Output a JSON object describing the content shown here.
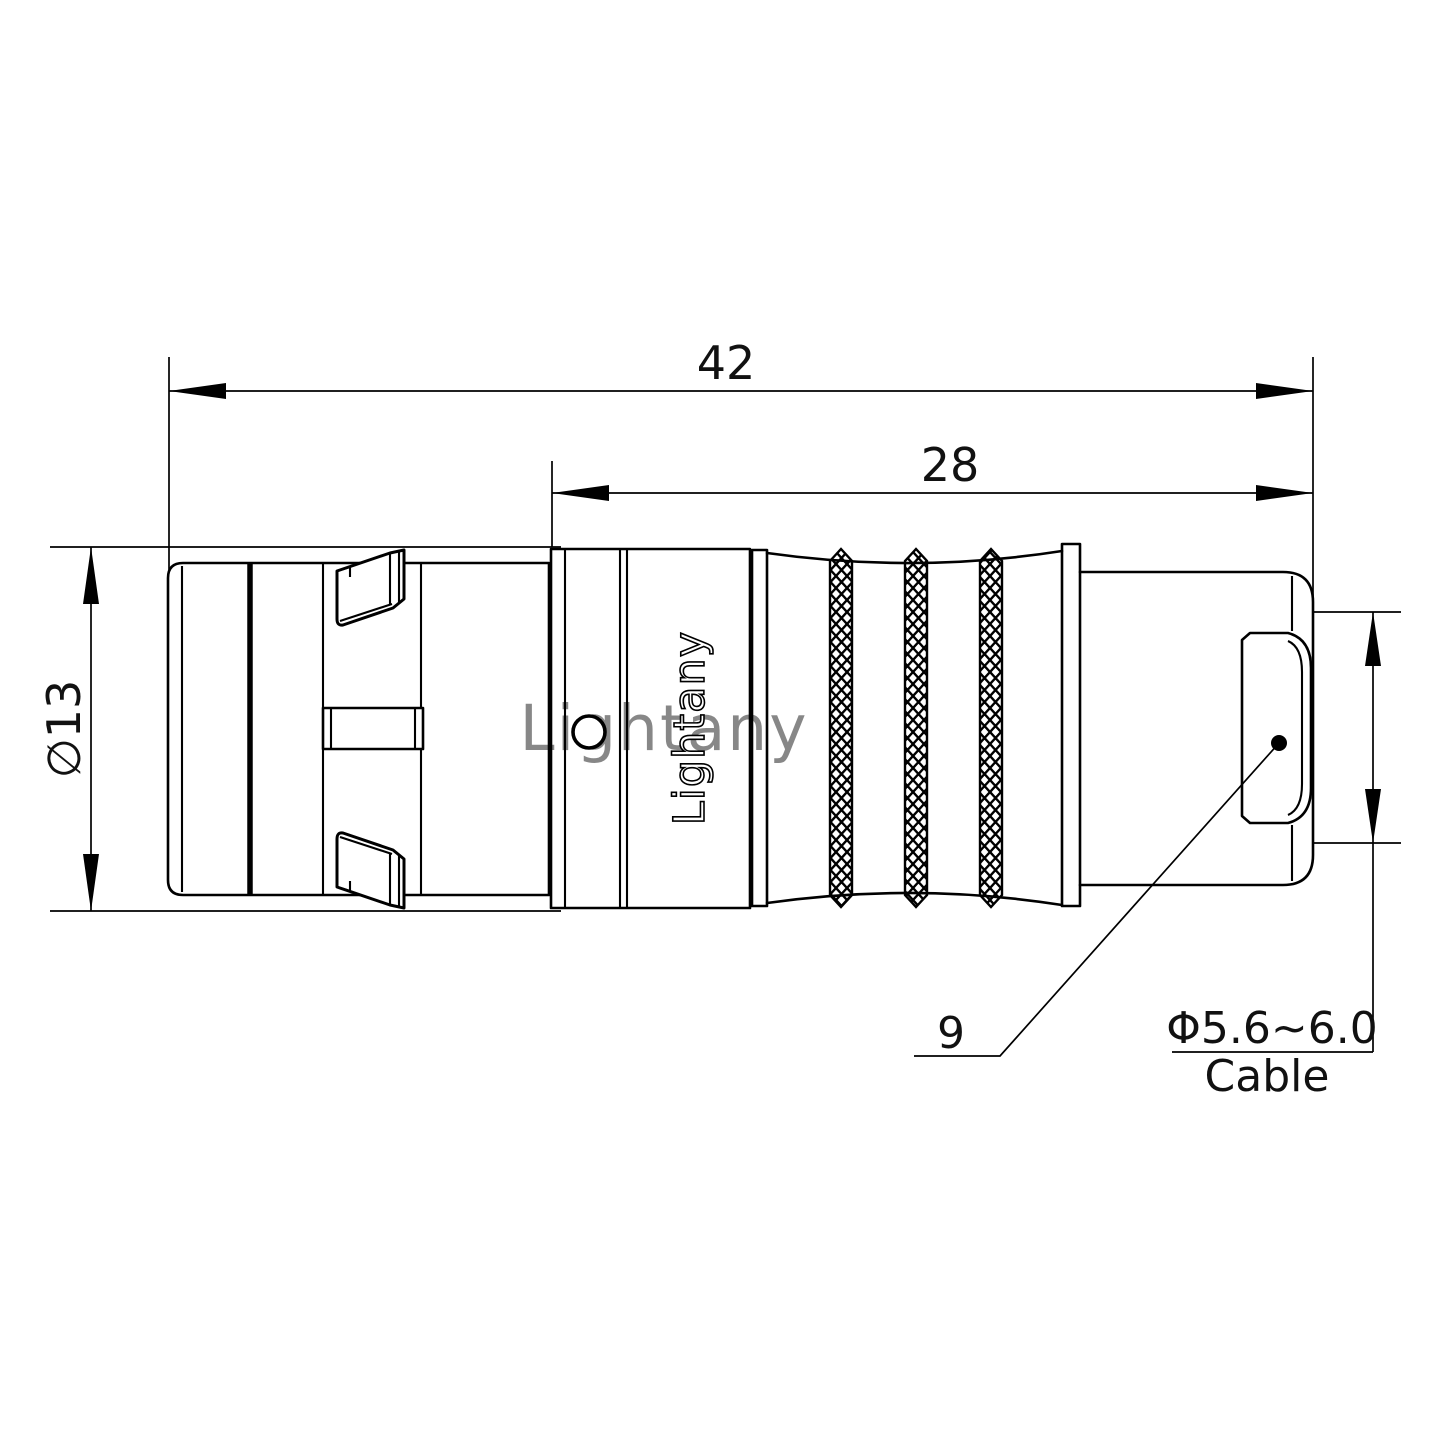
{
  "drawing": {
    "type": "connector-technical-drawing",
    "dimensions": {
      "overall_length": "42",
      "rear_length": "28",
      "outer_diameter": "∅13",
      "item_ref": "9",
      "cable_range": "Φ5.6~6.0",
      "cable_word": "Cable"
    },
    "brand_engraved": "Lightany",
    "watermark": "Lightany",
    "colors": {
      "line": "#000000",
      "watermark": "#ec9f9f",
      "background": "#ffffff"
    }
  }
}
